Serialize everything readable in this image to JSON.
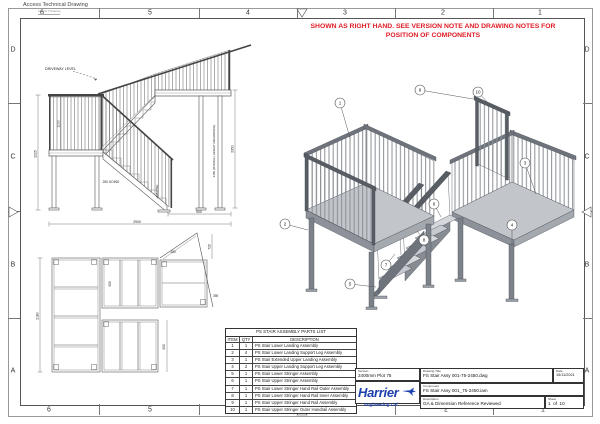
{
  "sheet": {
    "app_title": "Access Technical Drawing",
    "app_subtitle": "Access T Drawing",
    "border_cols": [
      "6",
      "5",
      "4",
      "3",
      "2",
      "1"
    ],
    "border_rows": [
      "D",
      "C",
      "B",
      "A"
    ],
    "note_line": "SHOWN AS RIGHT HAND. SEE VERSION NOTE AND DRAWING NOTES FOR POSITION OF COMPONENTS",
    "note_color": "#e01b24"
  },
  "elevation": {
    "driveway_label": "DRIVEWAY LEVEL",
    "dims": {
      "rail_height": "1100",
      "overall_left": "2225",
      "going": "250 GOING",
      "rise": "225 RISE",
      "landing_width": "900",
      "overall_width": "2900",
      "upper_height": "2350",
      "overall_height_ref": "2450 (OVERALL HEIGHT REFERENCE)"
    }
  },
  "plan": {
    "dims": {
      "depth": "2180",
      "upper_width": "900",
      "lower_width": "900",
      "extension_depth": "720",
      "extension_offset": "150",
      "extension_edge": "390"
    }
  },
  "iso": {
    "balloons": [
      "1",
      "2",
      "3",
      "4",
      "5",
      "6",
      "7",
      "8",
      "9",
      "10"
    ]
  },
  "parts_list": {
    "title": "PS STAIR ASSEMBLY PARTS LIST",
    "headers": [
      "ITEM",
      "QTY",
      "DESCRIPTION"
    ],
    "rows": [
      {
        "item": "1",
        "qty": "1",
        "description": "PS Stair Lower Landing Assembly"
      },
      {
        "item": "2",
        "qty": "4",
        "description": "PS Stair Lower Landing Support Leg Assembly"
      },
      {
        "item": "3",
        "qty": "1",
        "description": "PS Stair Extended Upper Landing Assembly"
      },
      {
        "item": "4",
        "qty": "2",
        "description": "PS Stair Upper Landing Support Leg Assembly"
      },
      {
        "item": "5",
        "qty": "1",
        "description": "PS Stair Lower Stringer Assembly"
      },
      {
        "item": "6",
        "qty": "1",
        "description": "PS Stair Upper Stringer Assembly"
      },
      {
        "item": "7",
        "qty": "1",
        "description": "PS Stair Lower Stringer Hand Rail Outer Assembly"
      },
      {
        "item": "8",
        "qty": "1",
        "description": "PS Stair Lower Stringer Hand Rail Inner Assembly"
      },
      {
        "item": "9",
        "qty": "1",
        "description": "PS Stair Upper Stringer Hand Rail Assembly"
      },
      {
        "item": "10",
        "qty": "1",
        "description": "PS Stair Upper Stringer Outer Handrail Assembly"
      }
    ]
  },
  "title_block": {
    "version_label": "Version",
    "version_value": "2400mm Plot 75",
    "drawing_title_label": "Drawing Title",
    "drawing_title_value": "FS Stair Assy 001-75-2450.dwg",
    "component_label": "Component",
    "component_value": "FS Stair Assy 001_75-2450.iam",
    "description_label": "Description",
    "description_value": "GA & Dimension Reference Reviewed",
    "date_label": "Date",
    "date_value": "15/11/2021",
    "sheet_label": "Sheet",
    "sheet_page": "1",
    "sheet_of": "of",
    "sheet_total": "10",
    "logo_name": "Harrier",
    "logo_sub": "Engineering Ltd",
    "logo_color": "#1c3fae"
  }
}
